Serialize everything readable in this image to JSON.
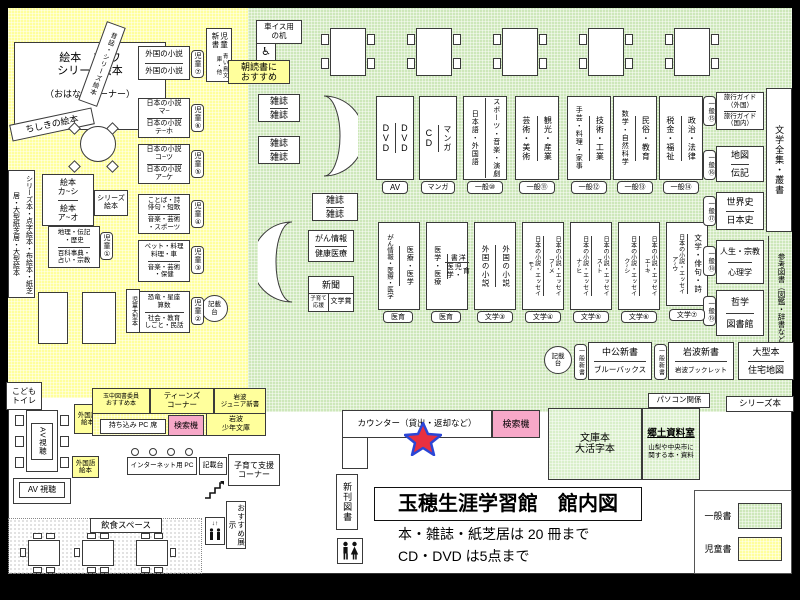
{
  "colors": {
    "general_green": "#cde7ba",
    "children_yellow": "#ffff9c",
    "search_pink": "#f7a8c8",
    "star_red": "#e83040",
    "star_blue": "#2b46d6",
    "page_bg": "#ffffff",
    "frame": "#000000"
  },
  "legend": {
    "general": "一般書",
    "children": "児童書"
  },
  "info": {
    "title": "玉穂生涯学習館　館内図",
    "rule_books": "本・雑誌・紙芝居は 20 冊まで",
    "rule_av": "CD・DVD は5点まで"
  },
  "ch": {
    "ehon1": "絵本　ス~ワ\nシリーズ絵本",
    "ohanashi": "（おはなしコーナー）",
    "mukashi": "昔話・シリーズ絵本",
    "chishiki": "ちしきの絵本",
    "gaikoku": {
      "c0": "外国の小説",
      "c1": "外国の小説",
      "badge": "児童⑦"
    },
    "shinsho": {
      "main": "児童新書",
      "sub": "青い鳥文庫・他"
    },
    "asadoku": "朝読書に\nおすすめ",
    "nihon1": {
      "c0": "日本の小説\nマ~",
      "c1": "日本の小説\nテ~ホ",
      "badge": "児童⑥"
    },
    "nihon2": {
      "c0": "日本の小説\nコ~ツ",
      "c1": "日本の小説\nア~ケ",
      "badge": "児童⑤"
    },
    "kotoba": {
      "c0": "ことば・詩\n俳句・短歌",
      "c1": "音楽・芸術\n・スポーツ",
      "badge": "児童④"
    },
    "pet": {
      "c0": "ペット・料理\n料理・車",
      "c1": "音楽・芸術\n・保健",
      "badge": "児童③"
    },
    "kyoryu": {
      "c0": "恐竜・星座\n算数",
      "c1": "社会・教育\nしごと・民話",
      "badge": "児童②"
    },
    "kaShi": {
      "c0": "絵本\nカ~シ",
      "c1": "絵本\nア~オ"
    },
    "seriesS": "シリーズ\n絵本",
    "chiri": {
      "c0": "地理・伝記\n・歴史",
      "c1": "百科事典・\n占い・宗教",
      "badge": "児童①"
    },
    "wall": "シリーズ本・点字絵本・布絵本・紙芝居・大型紙芝居・大型絵本",
    "ogata": "児童大型本",
    "toilet": "こども\nトイレ",
    "kisaidai": "記載\n台"
  },
  "gn": {
    "wheelchair": "車イス用\nの机",
    "wc_icon": "♿",
    "zasshi": "雑誌",
    "t0": {
      "c0": "DVD",
      "c1": "DVD",
      "badge": "AV"
    },
    "t1": {
      "c0": "CD",
      "c1": "マンガ",
      "badge": "マンガ"
    },
    "t2": {
      "c0": "日本語・外国語",
      "c1": "スポーツ・音楽・演劇",
      "badge": "一般⑩"
    },
    "t3": {
      "c0": "芸術・美術",
      "c1": "観光・産業",
      "badge": "一般⑪"
    },
    "t4": {
      "c0": "手芸・料理・家事",
      "c1": "技術・工業",
      "badge": "一般⑫"
    },
    "t5": {
      "c0": "数学・自然科学",
      "c1": "民俗・教育",
      "badge": "一般⑬"
    },
    "t6": {
      "c0": "税金・福祉",
      "c1": "政治・法律",
      "badge": "一般⑭"
    },
    "r0": {
      "c0": "旅行ガイド\n（外国）",
      "c1": "旅行ガイド\n（国内）",
      "badge": "一般⑮"
    },
    "r1": {
      "c0": "地図",
      "c1": "伝記",
      "badge": "一般⑯"
    },
    "r2": {
      "c0": "世界史",
      "c1": "日本史",
      "badge": "一般⑰"
    },
    "r3": {
      "c0": "人生・宗教",
      "c1": "心理学",
      "badge": "一般⑱"
    },
    "r4": {
      "c0": "哲学",
      "c1": "図書館",
      "badge": "一般⑲"
    },
    "zenshu": "文学全集・叢書",
    "sanko": "参考図書（図鑑・辞書など）",
    "m0": {
      "c0": "がん情報・医療・医学",
      "c1": "医療・医学",
      "badge": "医育"
    },
    "m1": {
      "c0": "医学・医療",
      "c1a": "洋書",
      "c1b": "育児・医学",
      "badge": "医育"
    },
    "m2": {
      "c0": "外国の小説",
      "c1": "外国の小説",
      "badge": "文学③"
    },
    "m3": {
      "c0": "日本の小説・エッセイ\nモ~",
      "c1": "日本の小説・エッセイ\nフ~メ",
      "badge": "文学④"
    },
    "m4": {
      "c0": "日本の小説・エッセイ\nナ~ヒ",
      "c1": "日本の小説・エッセイ\nス~ト",
      "badge": "文学⑤"
    },
    "m5": {
      "c0": "日本の小説・エッセイ\nク~シ",
      "c1": "日本の小説・エッセイ\nエ~キ",
      "badge": "文学⑥"
    },
    "m6": {
      "c0": "日本の小説・エッセイ\nア~ウ",
      "c1": "文学・俳句・詩",
      "badge": "文学⑦"
    },
    "gan": {
      "c0": "がん情報",
      "c1": "健康医療"
    },
    "shinbun": {
      "top": "新聞",
      "l": "子育て\n応援",
      "r": "文学賞"
    },
    "kisaidai": "記載\n台",
    "shinshoBadge": "一般新書",
    "chuko": {
      "c0": "中公新書",
      "c1": "ブルーバックス"
    },
    "iwanami": {
      "c0": "岩波新書",
      "c1": "岩波ブックレット"
    },
    "ogata": {
      "c0": "大型本",
      "c1": "住宅地図"
    },
    "pasokon": "パソコン関係",
    "seriesBon": "シリーズ本"
  },
  "lb": {
    "counter": "カウンター（貸出・返却など）",
    "search": "検索機",
    "shinkan": "新刊図書",
    "bunko": "文庫本\n大活字本",
    "kyodoTitle": "郷土資料室",
    "kyodoBody": "山梨や中央市に\n関する本・資料",
    "av1": "AV視聴",
    "av2": "AV 視聴",
    "gaikokugo": "外国語\n絵本",
    "tamachu": "玉中図書委員\nおすすめ本",
    "teens": "ティーンズ\nコーナー",
    "iwanamiJr": "岩波\nジュニア新書",
    "mochikomi": "持ち込み PC 席",
    "search2": "検索機",
    "shonen": "岩波\n少年文庫",
    "internet": "インターネット用 PC",
    "kisaidai": "記載台",
    "kosodate": "子育て支援\nコーナー",
    "osusume": "おすすめ展示",
    "inshoku": "飲食スペース",
    "elevator_arrows": "↓↑"
  }
}
